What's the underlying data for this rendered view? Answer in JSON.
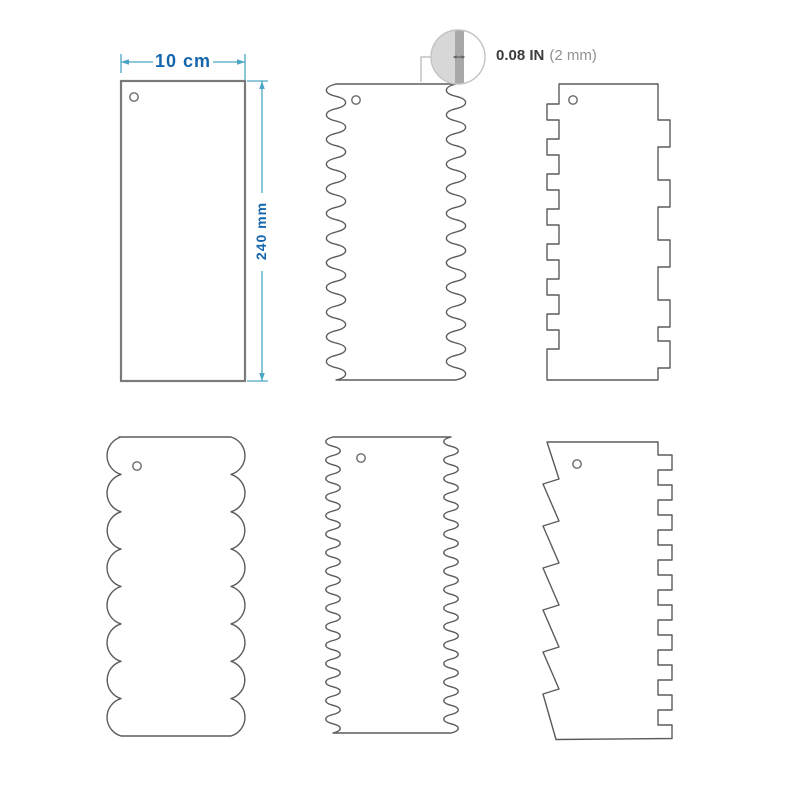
{
  "annotations": {
    "width_label": "10 cm",
    "height_label": "240 mm",
    "thickness_value": "0.08 IN",
    "thickness_metric": "(2 mm)"
  },
  "colors": {
    "dimension_line": "#4aa6c4",
    "dimension_text": "#1566ad",
    "outline": "#5b5b5b",
    "callout_stroke": "#c3c3c3",
    "callout_fill": "#d7d7d7",
    "callout_stripe": "#a8a8a8",
    "leader_line": "#b5b5b5"
  },
  "scrapers": [
    {
      "id": "scraper-plain",
      "edge_left": "straight",
      "edge_right": "straight"
    },
    {
      "id": "scraper-wave",
      "edge_left": "wave",
      "edge_right": "wave"
    },
    {
      "id": "scraper-square-tooth",
      "edge_left": "small-square-teeth",
      "edge_right": "large-square-notches"
    },
    {
      "id": "scraper-scallop",
      "edge_left": "large-scallops",
      "edge_right": "large-scallops"
    },
    {
      "id": "scraper-fine-wave",
      "edge_left": "fine-wave",
      "edge_right": "fine-wave"
    },
    {
      "id": "scraper-sawtooth",
      "edge_left": "sawtooth",
      "edge_right": "small-square-teeth"
    }
  ]
}
